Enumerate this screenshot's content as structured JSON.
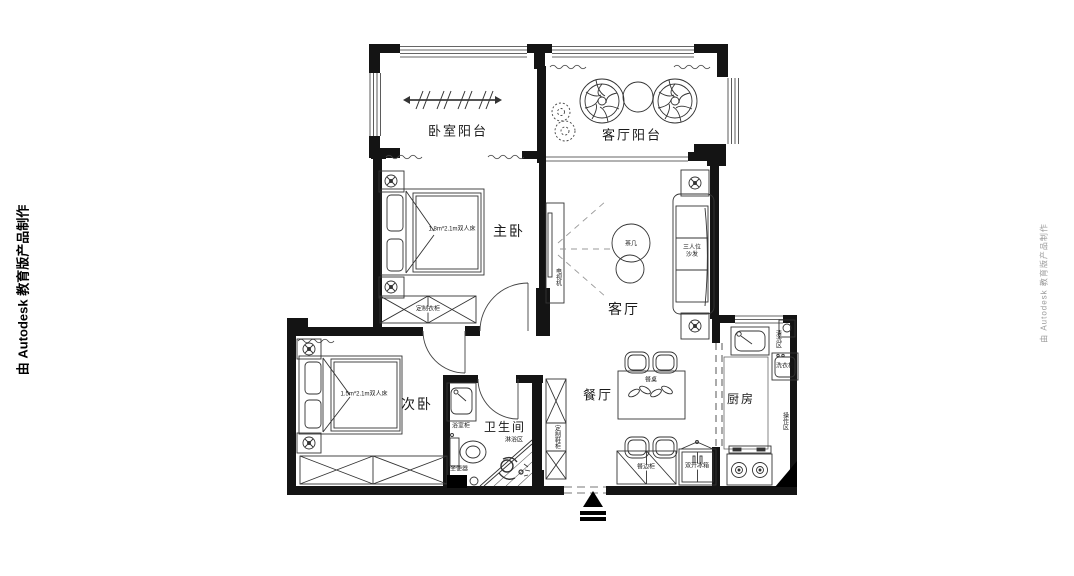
{
  "watermark": {
    "left": "由 Autodesk 教育版产品制作",
    "right": "由 Autodesk 教育版产品制作"
  },
  "rooms": {
    "bedroom_balcony": "卧室阳台",
    "living_balcony": "客厅阳台",
    "master_bedroom": "主卧",
    "living_room": "客厅",
    "second_bedroom": "次卧",
    "bathroom": "卫生间",
    "dining_room": "餐厅",
    "kitchen": "厨房"
  },
  "furniture": {
    "master_bed": "1.8m*2.1m双人床",
    "master_wardrobe": "定制衣柜",
    "tv": "电视机",
    "coffee_table": "茶几",
    "sofa": "三人位沙发",
    "second_bed": "1.5m*2.1m双人床",
    "vanity": "浴室柜",
    "toilet": "坐便器",
    "shower": "淋浴区",
    "shoe_cabinet": "定制鞋柜",
    "dining_table": "餐桌",
    "sideboard": "餐边柜",
    "fridge": "双开冰箱",
    "sink_area": "清洗区",
    "washing_machine": "洗衣机",
    "work_area": "操作区"
  }
}
